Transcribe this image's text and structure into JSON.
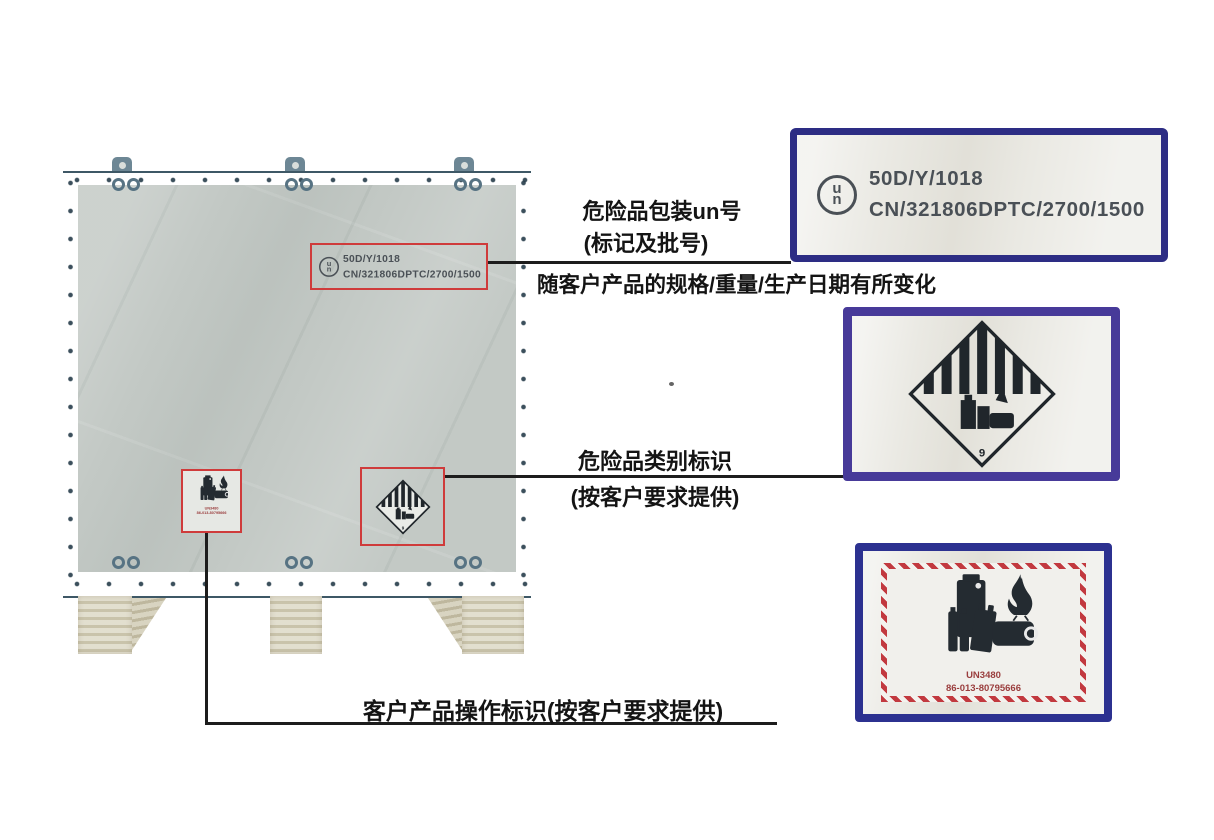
{
  "annotations": {
    "packaging": {
      "line1": "危险品包装un号",
      "line2": "(标记及批号)",
      "line3": "随客户产品的规格/重量/生产日期有所变化"
    },
    "category": {
      "line1": "危险品类别标识",
      "line2": "(按客户要求提供)"
    },
    "handling": {
      "line1": "客户产品操作标识(按客户要求提供)"
    }
  },
  "labels": {
    "un_label": {
      "symbol_top": "u",
      "symbol_bottom": "n",
      "line1": "50D/Y/1018",
      "line2": "CN/321806DPTC/2700/1500"
    },
    "class9_label": {
      "number": "9"
    },
    "battery_label": {
      "un_number": "UN3480",
      "contact": "86-013-80795666"
    }
  },
  "colors": {
    "highlight_red": "#cf3b3b",
    "hatch_red": "#c2393f",
    "border_navy": "#2d2d84",
    "border_purple": "#473a99",
    "border_blue": "#2c3190",
    "steel_blue": "#5d7a8a",
    "plywood": "#c3c9c5",
    "pallet_wood": "#d9d4bf",
    "graphic_dark": "#242b31",
    "connector_black": "#1d1d1d"
  }
}
